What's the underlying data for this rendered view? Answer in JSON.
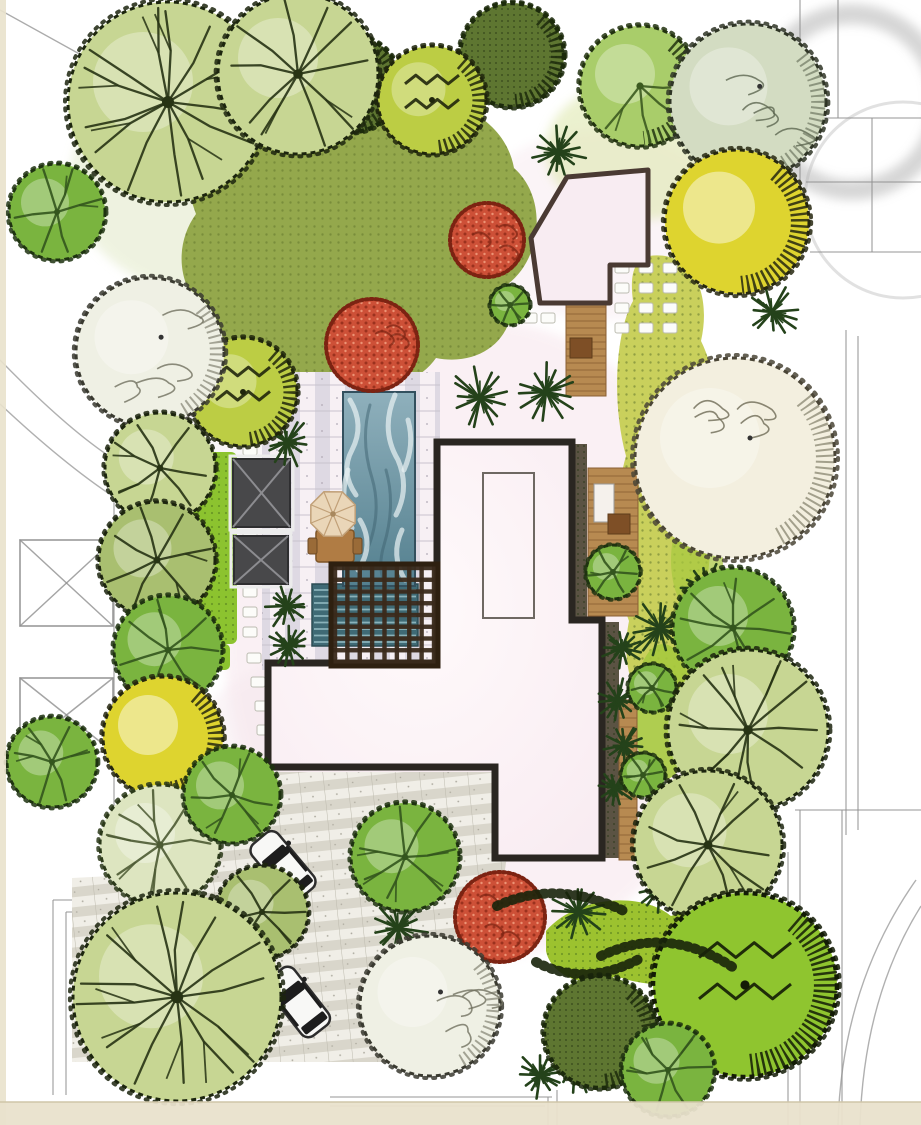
{
  "plan": {
    "canvas": {
      "w": 921,
      "h": 1125
    },
    "palette": {
      "cad": "#8f8f8f",
      "ring": "#b5b5b5",
      "band": "#e9e2cc",
      "bandLine": "#cfc6a8",
      "houseFill1": "#fffafb",
      "houseFill2": "#f8ebf1",
      "houseEdge": "#2a2621",
      "gazeboFill": "#f8ecf2",
      "gazeboEdge": "#4a3a33",
      "pavilionFill": "#48484a",
      "pavilionRidge": "#8c8c90",
      "pavilionHalo": "#ececec",
      "pergola": "#3a2a1b",
      "pergolaEdge": "#2e2010",
      "deck": "#b78a51",
      "deckLine": "#8a5f33",
      "deckTable": "#7e4f26",
      "poolTop": "#8fb0bc",
      "poolBottom": "#54808f",
      "poolEdge": "#33505e",
      "poolLower": "#3f6a75",
      "poolLowerLine": "#a3cbd1",
      "swirlLight": "#eaf2f4",
      "swirlDark": "#3d6170",
      "stone": "#fcfcf9",
      "stoneEdge": "#bdbdb2",
      "umbrella": "#ead6b8",
      "umbrellaRib": "#c1a078",
      "carBody": "#f8f8f6",
      "carEdge": "#2d2d2d",
      "carGlass": "#1d1d1d",
      "bed": "#4d4533",
      "lawnOlive": "#94a84c",
      "lawnYellow": "#c9d05c",
      "lawnBright": "#a6c93e",
      "lawnLime": "#9cc22f",
      "stripGreen": "#8cc32f",
      "hedge": "#18230b",
      "fern": "#24421a",
      "trees": {
        "sketch": {
          "fill": "#c7d693",
          "edge": "#1c250e",
          "detail": "#273314"
        },
        "sketchDark": {
          "fill": "#a9bf70",
          "edge": "#1c250e",
          "detail": "#273314"
        },
        "pale": {
          "fill": "#eff0e4",
          "edge": "#3a3a30",
          "detail": "#70705f"
        },
        "paleGreen": {
          "fill": "#dde5c0",
          "edge": "#2c3a1a",
          "detail": "#4c5a33"
        },
        "cream": {
          "fill": "#f3efdf",
          "edge": "#4a4536",
          "detail": "#6e6a55"
        },
        "sage": {
          "fill": "#d3dcc2",
          "edge": "#2f3526",
          "detail": "#5d6650"
        },
        "yellow": {
          "fill": "#ded42f",
          "edge": "#26270f",
          "detail": "#8a7d12"
        },
        "mid": {
          "fill": "#7ab43f",
          "edge": "#1e3310",
          "detail": "#33551d"
        },
        "leafy": {
          "fill": "#a9cd6a",
          "edge": "#22330f",
          "detail": "#3c5a20"
        },
        "scrib": {
          "fill": "#8fc52f",
          "edge": "#131b06",
          "detail": "#1d2a0a"
        },
        "scribYG": {
          "fill": "#bccd44, ",
          "edge": "#20260c",
          "detail": "#2a3310"
        },
        "speckle": {
          "fill": "#5e7631, ",
          "edge": "#1c2a0c",
          "detail": "#23360f"
        },
        "red": {
          "fill": "#cd5037",
          "edge": "#7c2312",
          "detail": "#8e2a18"
        }
      }
    },
    "cad": {
      "lines": [
        [
          0,
          10,
          112,
          72
        ],
        [
          800,
          0,
          800,
          252
        ],
        [
          838,
          0,
          838,
          118
        ],
        [
          800,
          118,
          921,
          118
        ],
        [
          872,
          118,
          872,
          252
        ],
        [
          806,
          182,
          921,
          182
        ],
        [
          810,
          252,
          921,
          252
        ],
        [
          846,
          330,
          846,
          835
        ],
        [
          858,
          336,
          858,
          830
        ],
        [
          795,
          810,
          921,
          810
        ],
        [
          800,
          810,
          800,
          1125
        ],
        [
          842,
          810,
          842,
          1125
        ],
        [
          788,
          852,
          788,
          1125
        ],
        [
          114,
          432,
          114,
          898
        ],
        [
          53,
          900,
          420,
          900
        ],
        [
          53,
          900,
          53,
          1095
        ],
        [
          66,
          912,
          420,
          912
        ],
        [
          66,
          912,
          66,
          1095
        ],
        [
          330,
          1097,
          552,
          1097
        ],
        [
          330,
          1106,
          545,
          1106
        ],
        [
          548,
          1097,
          548,
          1125
        ],
        [
          557,
          1090,
          557,
          1125
        ],
        [
          236,
          814,
          336,
          910
        ]
      ],
      "arcs": [
        "M0,360 Q70,432 118,462",
        "M0,404 Q64,464 114,497",
        "M916,880 Q842,985 838,1125",
        "M921,906 Q864,997 860,1125"
      ],
      "rings": [
        {
          "cx": 852,
          "cy": 102,
          "r": 88,
          "w": 20,
          "o": 0.55,
          "blur": true
        },
        {
          "cx": 903,
          "cy": 200,
          "r": 98,
          "w": 3,
          "o": 0.4,
          "blur": false
        }
      ],
      "crossBoxes": [
        [
          20,
          540,
          93,
          86
        ],
        [
          20,
          678,
          93,
          74
        ]
      ]
    },
    "washes": [
      {
        "cx": 480,
        "cy": 640,
        "rx": 255,
        "ry": 320,
        "fill": "#f7e5ec",
        "o": 0.55
      },
      {
        "cx": 600,
        "cy": 225,
        "rx": 130,
        "ry": 95,
        "fill": "#f8eaf0",
        "o": 0.5
      },
      {
        "cx": 350,
        "cy": 770,
        "rx": 170,
        "ry": 120,
        "fill": "#f5e7ed",
        "o": 0.45
      },
      {
        "cx": 300,
        "cy": 420,
        "rx": 120,
        "ry": 90,
        "fill": "#f2e9f0",
        "o": 0.4
      },
      {
        "cx": 230,
        "cy": 180,
        "rx": 160,
        "ry": 120,
        "fill": "#dfe7c2",
        "o": 0.5
      },
      {
        "cx": 640,
        "cy": 150,
        "rx": 95,
        "ry": 70,
        "fill": "#dce6a8",
        "o": 0.55
      }
    ],
    "lawns": {
      "top": "M205,142 C245,92 320,82 388,104 C448,88 505,118 514,168 C548,198 542,258 508,284 C524,330 486,368 436,358 C410,396 336,402 302,372 C252,392 208,362 210,316 C176,290 174,244 196,214 C182,176 188,158 205,142 Z",
      "right": "M649,256 C692,250 712,292 701,341 C721,381 716,431 701,471 C717,521 711,581 696,626 C701,671 681,711 656,706 C631,701 621,661 629,621 C611,571 613,501 626,456 C611,401 616,331 633,301 C629,271 636,259 649,256 Z",
      "bottom": "M546,931 C576,896 641,891 671,916 C711,901 741,931 726,961 C701,986 656,991 616,976 C586,991 551,976 546,951 Z",
      "brightSpots": [
        [
          663,
          712,
          30,
          68,
          0.9
        ],
        [
          697,
          560,
          26,
          55,
          0.7
        ]
      ],
      "leftStrip": [
        193,
        452,
        44,
        192
      ],
      "leftStripSmall": [
        200,
        644,
        30,
        26
      ]
    },
    "paving": {
      "patio": [
        262,
        372,
        178,
        298
      ],
      "driveway": [
        [
          190,
          772
        ],
        [
          512,
          772
        ],
        [
          512,
          820
        ],
        [
          478,
          1062
        ],
        [
          72,
          1062
        ],
        [
          72,
          878
        ],
        [
          190,
          872
        ]
      ]
    },
    "beds": [
      [
        574,
        444,
        13,
        176
      ],
      [
        604,
        622,
        15,
        236
      ]
    ],
    "water": {
      "pool": [
        343,
        392,
        72,
        194
      ],
      "poolLower": [
        312,
        584,
        106,
        62
      ],
      "swirlsLight": [
        "M350,400 Q365,425 352,450 Q340,472 356,495",
        "M395,395 Q380,430 398,460 Q410,488 396,515",
        "M360,520 Q375,545 358,570",
        "M402,530 Q390,555 405,580",
        "M348,470 Q338,500 352,528",
        "M408,420 Q415,445 404,470"
      ],
      "swirlsDark": [
        "M370,405 Q360,440 372,478 Q382,512 368,548",
        "M386,470 Q396,505 384,545 Q376,572 388,588"
      ]
    },
    "pergola": {
      "rect": [
        331,
        564,
        107,
        102
      ],
      "bars": 9
    },
    "decks": [
      {
        "rect": [
          566,
          300,
          40,
          96
        ],
        "step": 7
      },
      {
        "rect": [
          588,
          468,
          50,
          148
        ],
        "step": 8
      },
      {
        "rect": [
          619,
          700,
          18,
          160
        ],
        "step": 9
      }
    ],
    "deckFurniture": {
      "whiteRect": [
        594,
        484,
        20,
        38
      ],
      "table": [
        608,
        514,
        22,
        20
      ],
      "tableA": [
        570,
        338,
        22,
        20
      ]
    },
    "house": {
      "points": [
        [
          437,
          442
        ],
        [
          572,
          442
        ],
        [
          572,
          620
        ],
        [
          602,
          620
        ],
        [
          602,
          858
        ],
        [
          495,
          858
        ],
        [
          495,
          767
        ],
        [
          268,
          767
        ],
        [
          268,
          663
        ],
        [
          437,
          663
        ]
      ],
      "innerRect": [
        483,
        473,
        51,
        145
      ]
    },
    "gazebo": {
      "points": [
        [
          531,
          238
        ],
        [
          567,
          177
        ],
        [
          648,
          170
        ],
        [
          648,
          265
        ],
        [
          610,
          265
        ],
        [
          610,
          303
        ],
        [
          540,
          303
        ]
      ]
    },
    "pavilions": [
      [
        233,
        459,
        57,
        68
      ],
      [
        234,
        536,
        54,
        48
      ]
    ],
    "umbrella": {
      "cx": 333,
      "cy": 514,
      "r": 24,
      "table": [
        316,
        530,
        38,
        32
      ],
      "chairL": [
        308,
        538,
        9,
        16
      ],
      "chairR": [
        353,
        538,
        9,
        16
      ]
    },
    "stones": [
      [
        250,
        450
      ],
      [
        250,
        472
      ],
      [
        250,
        515
      ],
      [
        250,
        535
      ],
      [
        250,
        592
      ],
      [
        250,
        612
      ],
      [
        250,
        632
      ],
      [
        254,
        658
      ],
      [
        258,
        682
      ],
      [
        262,
        706
      ],
      [
        264,
        730
      ],
      [
        622,
        268
      ],
      [
        646,
        268
      ],
      [
        670,
        268
      ],
      [
        622,
        288
      ],
      [
        646,
        288
      ],
      [
        670,
        288
      ],
      [
        622,
        308
      ],
      [
        646,
        308
      ],
      [
        670,
        308
      ],
      [
        622,
        328
      ],
      [
        646,
        328
      ],
      [
        670,
        328
      ],
      [
        512,
        318
      ],
      [
        530,
        318
      ],
      [
        548,
        318
      ]
    ],
    "cars": [
      {
        "x": 283,
        "y": 866,
        "a": -40
      },
      {
        "x": 298,
        "y": 1002,
        "a": -38
      }
    ],
    "plants": {
      "reds": [
        [
          372,
          345,
          46
        ],
        [
          487,
          240,
          37
        ],
        [
          500,
          917,
          45
        ]
      ],
      "ferns": [
        [
          480,
          398,
          30
        ],
        [
          546,
          392,
          30
        ],
        [
          287,
          442,
          24
        ],
        [
          287,
          606,
          22
        ],
        [
          289,
          646,
          20
        ],
        [
          660,
          628,
          30
        ],
        [
          706,
          588,
          24
        ],
        [
          558,
          152,
          26
        ],
        [
          398,
          928,
          28
        ],
        [
          578,
          912,
          26
        ],
        [
          575,
          1062,
          30
        ],
        [
          660,
          888,
          24
        ],
        [
          772,
          312,
          26
        ],
        [
          622,
          648,
          20
        ],
        [
          618,
          700,
          20
        ],
        [
          624,
          745,
          20
        ],
        [
          615,
          788,
          18
        ],
        [
          540,
          1075,
          24
        ]
      ],
      "trees": [
        [
          352,
          84,
          48,
          "speckle"
        ],
        [
          512,
          55,
          52,
          "speckle"
        ],
        [
          432,
          100,
          54,
          "scribYG"
        ],
        [
          640,
          86,
          60,
          "leafy"
        ],
        [
          168,
          102,
          100,
          "sketch"
        ],
        [
          298,
          74,
          80,
          "sketch"
        ],
        [
          748,
          102,
          78,
          "sage"
        ],
        [
          737,
          222,
          72,
          "yellow"
        ],
        [
          57,
          212,
          48,
          "mid"
        ],
        [
          243,
          392,
          54,
          "scribYG"
        ],
        [
          150,
          352,
          74,
          "pale"
        ],
        [
          160,
          468,
          55,
          "sketch"
        ],
        [
          157,
          560,
          58,
          "sketchDark"
        ],
        [
          168,
          650,
          54,
          "mid"
        ],
        [
          163,
          737,
          60,
          "yellow"
        ],
        [
          52,
          762,
          45,
          "mid"
        ],
        [
          160,
          845,
          60,
          "paleGreen"
        ],
        [
          733,
          628,
          60,
          "mid"
        ],
        [
          652,
          688,
          24,
          "mid"
        ],
        [
          643,
          775,
          22,
          "mid"
        ],
        [
          748,
          730,
          80,
          "sketch"
        ],
        [
          708,
          845,
          74,
          "sketch"
        ],
        [
          735,
          458,
          100,
          "cream"
        ],
        [
          510,
          305,
          20,
          "mid"
        ],
        [
          613,
          572,
          27,
          "mid"
        ],
        [
          232,
          795,
          48,
          "mid"
        ],
        [
          405,
          857,
          54,
          "mid"
        ],
        [
          262,
          912,
          46,
          "sketchDark"
        ],
        [
          745,
          985,
          92,
          "scrib"
        ],
        [
          600,
          1032,
          56,
          "speckle"
        ],
        [
          668,
          1070,
          46,
          "mid"
        ],
        [
          430,
          1006,
          70,
          "pale"
        ],
        [
          177,
          997,
          104,
          "sketch"
        ]
      ],
      "hedges": [
        "M497,906 Q557,878 626,912",
        "M601,956 Q668,924 734,968",
        "M536,962 Q586,988 641,958"
      ]
    },
    "bands": {
      "left": [
        0,
        0,
        6,
        1125
      ],
      "bottom": [
        0,
        1102,
        921,
        23
      ]
    }
  }
}
